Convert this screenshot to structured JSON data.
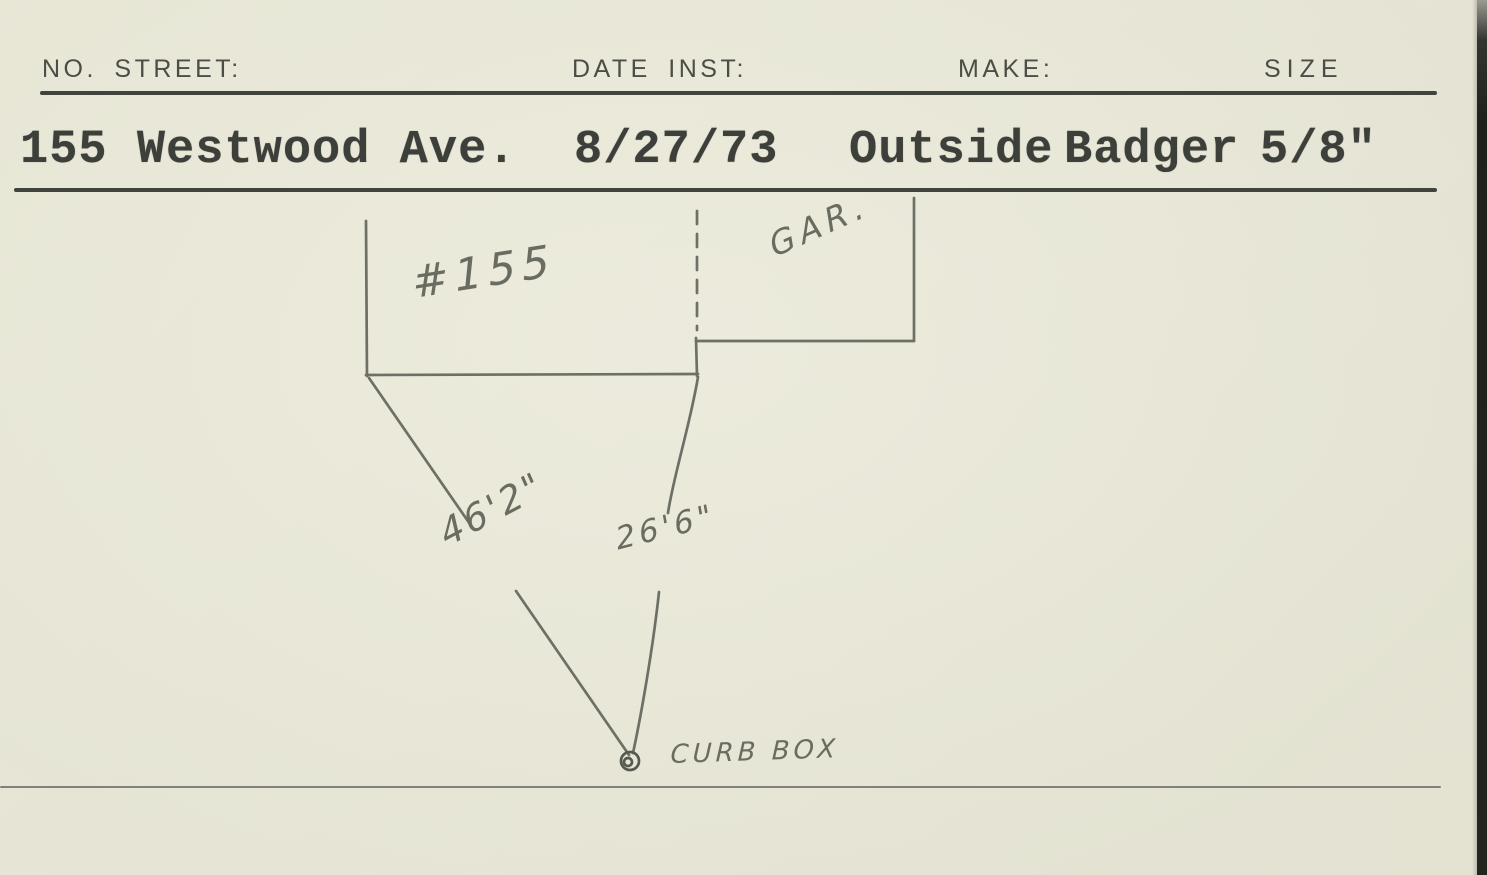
{
  "colors": {
    "paper": "#eae9d9",
    "typed_ink": "#3d403a",
    "printed_ink": "#4b4e46",
    "pencil": "#6d7066",
    "rule": "#41443d",
    "scan_edge": "#1f211d"
  },
  "header": {
    "no_street_label": "NO. STREET:",
    "date_inst_label": "DATE INST:",
    "make_label": "MAKE:",
    "size_label": "SIZE"
  },
  "record": {
    "no_street": "155 Westwood Ave.",
    "date_inst": "8/27/73",
    "location": "Outside",
    "make": "Badger",
    "size": "5/8\""
  },
  "sketch": {
    "house_label": "#155",
    "garage_label": "GAR.",
    "distance_house_corner": "46'2\"",
    "distance_property_line": "26'6\"",
    "curb_box_label": "CURB BOX"
  }
}
